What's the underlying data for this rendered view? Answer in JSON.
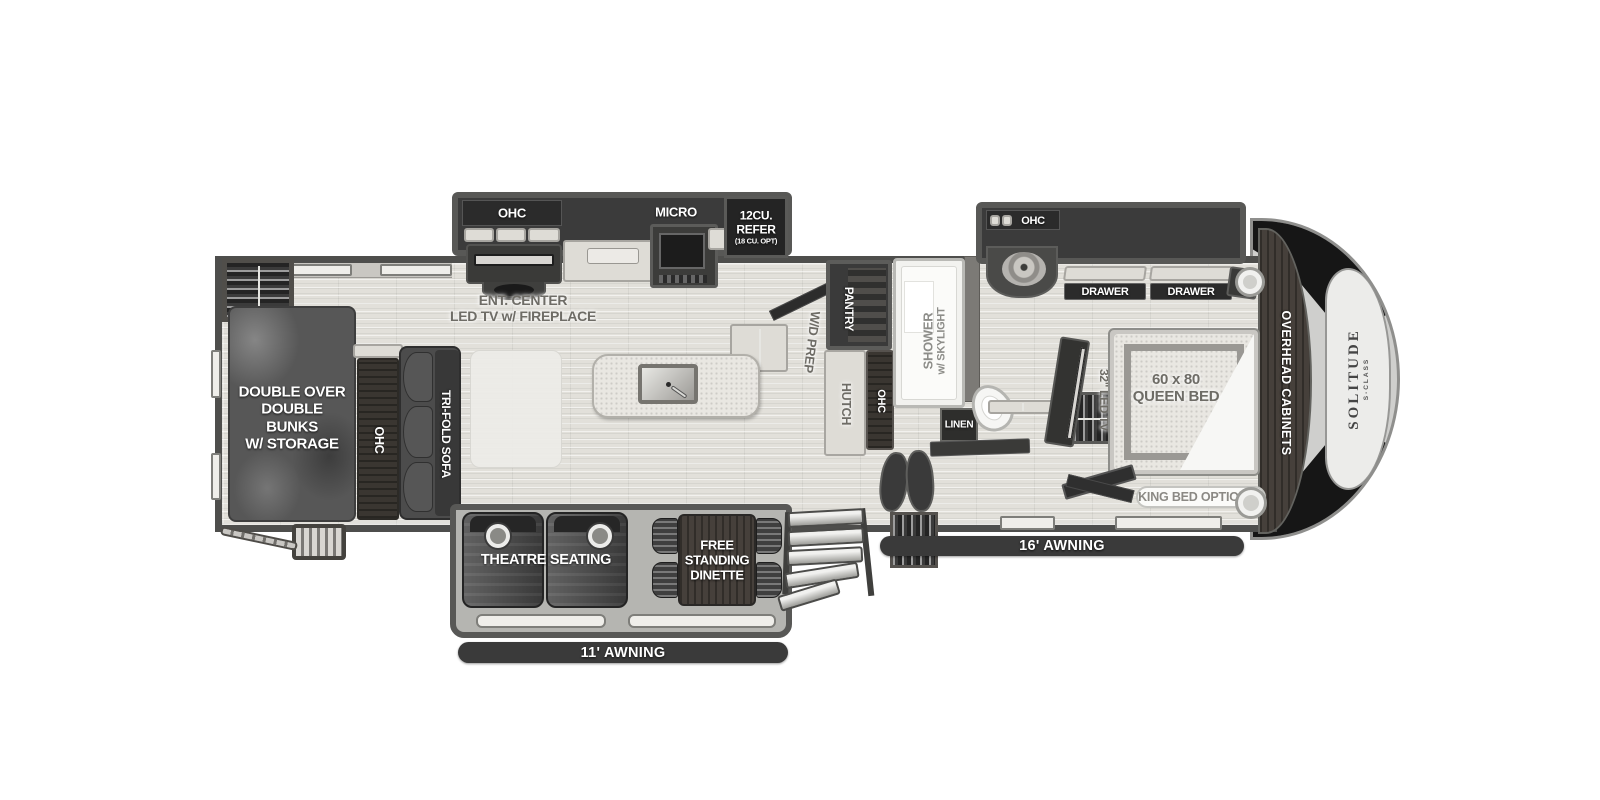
{
  "labels": {
    "ohc_kitchen": "OHC",
    "micro": "MICRO",
    "refer_l1": "12CU.",
    "refer_l2": "REFER",
    "refer_l3": "(18 CU. OPT)",
    "ent_l1": "ENT. CENTER",
    "ent_l2": "LED TV w/ FIREPLACE",
    "wd_prep": "W/D PREP",
    "pantry": "PANTRY",
    "hutch": "HUTCH",
    "ohc_hall": "OHC",
    "shower_l1": "SHOWER",
    "shower_l2": "w/ SKYLIGHT",
    "linen": "LINEN",
    "ohc_bath": "OHC",
    "drawer_left": "DRAWER",
    "drawer_right": "DRAWER",
    "led_tv": "32\" LED TV",
    "queen_l1": "60 x 80",
    "queen_l2": "QUEEN BED",
    "overhead_cabinets": "OVERHEAD CABINETS",
    "king_bed": "KING BED OPTIONAL",
    "brand": "SOLITUDE",
    "brand_class": "S-CLASS",
    "bunks_l1": "DOUBLE OVER",
    "bunks_l2": "DOUBLE",
    "bunks_l3": "BUNKS",
    "bunks_l4": "W/ STORAGE",
    "ohc_bunk": "OHC",
    "trifold": "TRI-FOLD SOFA",
    "theatre": "THEATRE SEATING",
    "dinette_l1": "FREE",
    "dinette_l2": "STANDING",
    "dinette_l3": "DINETTE",
    "awning11": "11' AWNING",
    "awning16": "16' AWNING"
  },
  "colors": {
    "wall": "#4e4e4c",
    "floor": "#e2e0da",
    "slide_dark": "#3b3b3b",
    "awning_bar": "#3a3a3a",
    "label_gray": "#6e6c66",
    "cap_black": "#161616"
  }
}
